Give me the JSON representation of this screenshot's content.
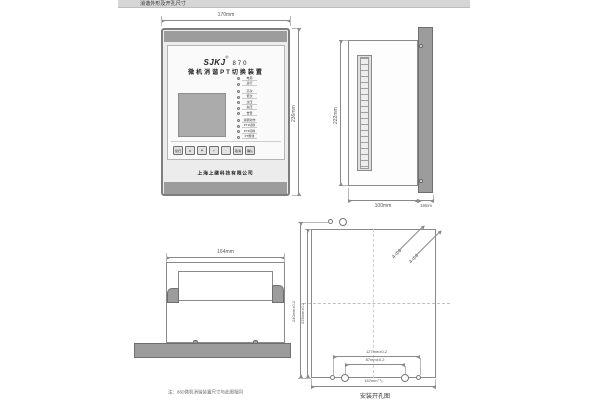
{
  "header": {
    "title": "消谐外形及开孔尺寸"
  },
  "front_view": {
    "width_dim": "170mm",
    "height_dim": "236mm",
    "brand": "SJKJ",
    "reg_mark": "®",
    "model": "870",
    "device_title": "微机消谐PT切换装置",
    "leds": [
      "电源",
      "运行",
      "高次",
      "低次",
      "过压",
      "失压",
      "告警",
      "消谐动作",
      "PT1切换",
      "PT2切换",
      "PT断线"
    ],
    "buttons": [
      {
        "label": "复归"
      },
      {
        "label": "▲"
      },
      {
        "label": "▼"
      },
      {
        "label": "+"
      },
      {
        "label": "-"
      },
      {
        "label": "取消"
      },
      {
        "label": "确认"
      }
    ],
    "company": "上海上继科技有限公司"
  },
  "side_view": {
    "height_dim": "222mm",
    "depth_dim": "100mm",
    "panel_dim": "19mm"
  },
  "top_view": {
    "width_dim": "164mm"
  },
  "cutout_view": {
    "outer_height_dim": "240mm±0.2",
    "inner_height_dim": "225mm±0.2",
    "outer_span_dim": "127mm±0.2",
    "inner_span_dim": "87mm±0.2",
    "width_dim": "167mm⁺¹₀",
    "hole_label_a": "4-Φ6",
    "hole_label_b": "4-Φ6",
    "caption": "安装开孔图"
  },
  "note": "注：860微机消谐装置尺寸与此图相同"
}
